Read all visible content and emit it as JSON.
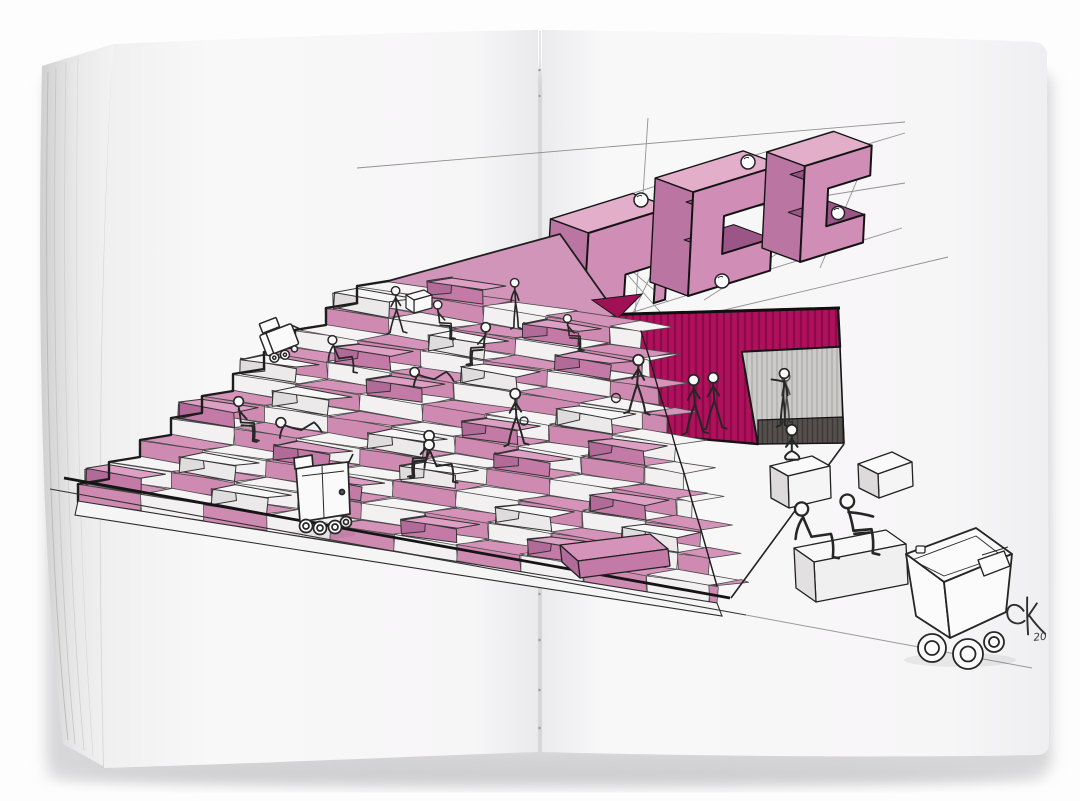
{
  "scene": {
    "type": "photographed sketchbook spread",
    "description": "Open stitched sketchbook spread with a hand-drawn architectural concept sketch: a checkerboard amphitheater stair of pink and white seating blocks filled with sketched people, small delivery robots and carts, a striped magenta wall with a doorway opening, and three blocky 3D signage letters drawn in perspective with construction lines and guide spheres.",
    "objects": [
      "sketchbook pages",
      "stitched center fold",
      "amphitheater steps",
      "pink and white seating blocks",
      "sketched figures",
      "stair-climbing cart",
      "delivery robot",
      "cargo cart with packages",
      "magenta striped wall",
      "doorway opening",
      "blocky 3D letters",
      "perspective construction lines",
      "guide spheres",
      "artist signature"
    ]
  },
  "palette": {
    "backdrop": "#fdfdfd",
    "paper": "#f7f6f7",
    "paper_shade": "#e9e8ea",
    "ink": "#1c1c1c",
    "construction": "#6a6a6a",
    "pink_tread": "#d593b9",
    "pink_riser": "#cf8ab1",
    "pink_box_top": "#dd9fc3",
    "pink_box_front": "#c47aa7",
    "pink_box_side": "#b26b98",
    "white_tread": "#f5f3f4",
    "white_riser": "#f2f0f1",
    "white_box_top": "#f8f7f8",
    "white_box_front": "#ebe9ea",
    "white_box_side": "#dedcdd",
    "letter_front": "#d08eb6",
    "letter_top": "#e2aeca",
    "letter_side": "#bb75a2",
    "letter_inner": "#9b5586",
    "wall_magenta": "#b1115c",
    "wall_stripe": "#8c0a4a",
    "door_gray": "#cdcbc9",
    "door_hatch": "#a9a7a5",
    "door_band": "#55504d"
  },
  "signature": {
    "monogram": "CK",
    "year": "20"
  },
  "counts": {
    "step_rows": 10,
    "letters": 3,
    "people": 20,
    "robots_and_carts": 3
  }
}
